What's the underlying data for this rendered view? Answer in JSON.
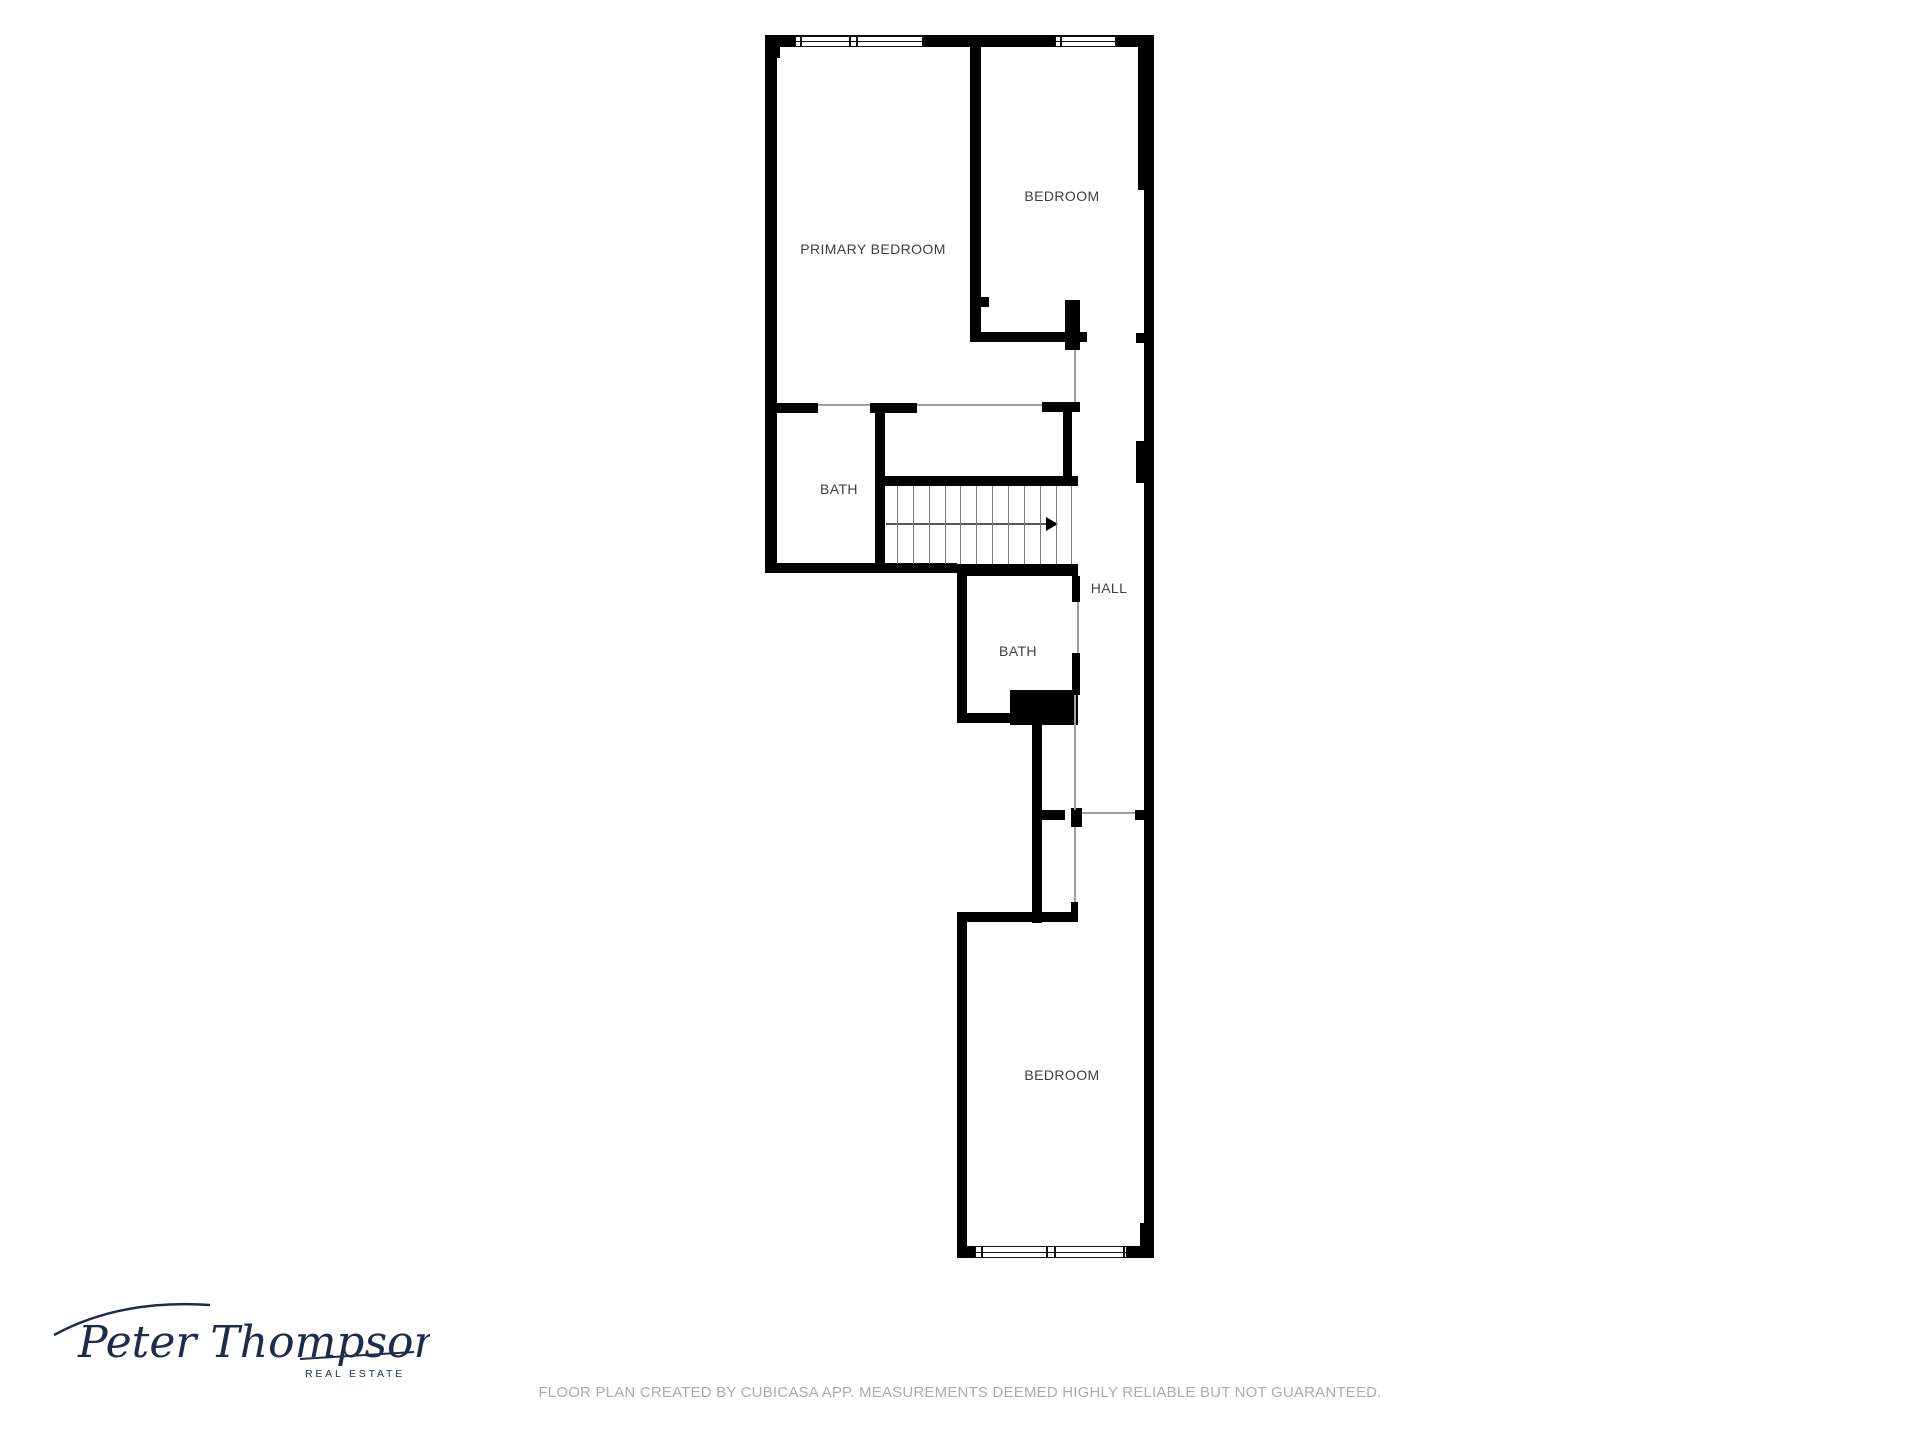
{
  "floor_plan": {
    "rooms": [
      {
        "label": "PRIMARY BEDROOM"
      },
      {
        "label": "BEDROOM"
      },
      {
        "label": "BATH"
      },
      {
        "label": "HALL"
      },
      {
        "label": "BATH"
      },
      {
        "label": "BEDROOM"
      }
    ],
    "stairs": {
      "arrow_direction": "right"
    }
  },
  "branding": {
    "logo_name": "Peter Thompson",
    "logo_subtitle": "REAL ESTATE"
  },
  "footer": {
    "disclaimer": "FLOOR PLAN CREATED BY CUBICASA APP. MEASUREMENTS DEEMED HIGHLY RELIABLE BUT NOT GUARANTEED."
  },
  "colors": {
    "wall": "#000000",
    "room_label": "#3f3f3f",
    "opening_line": "#9e9e9e",
    "stair_line": "#7a7a7a",
    "disclaimer_text": "#acacac",
    "logo": "#1e2b4c"
  }
}
